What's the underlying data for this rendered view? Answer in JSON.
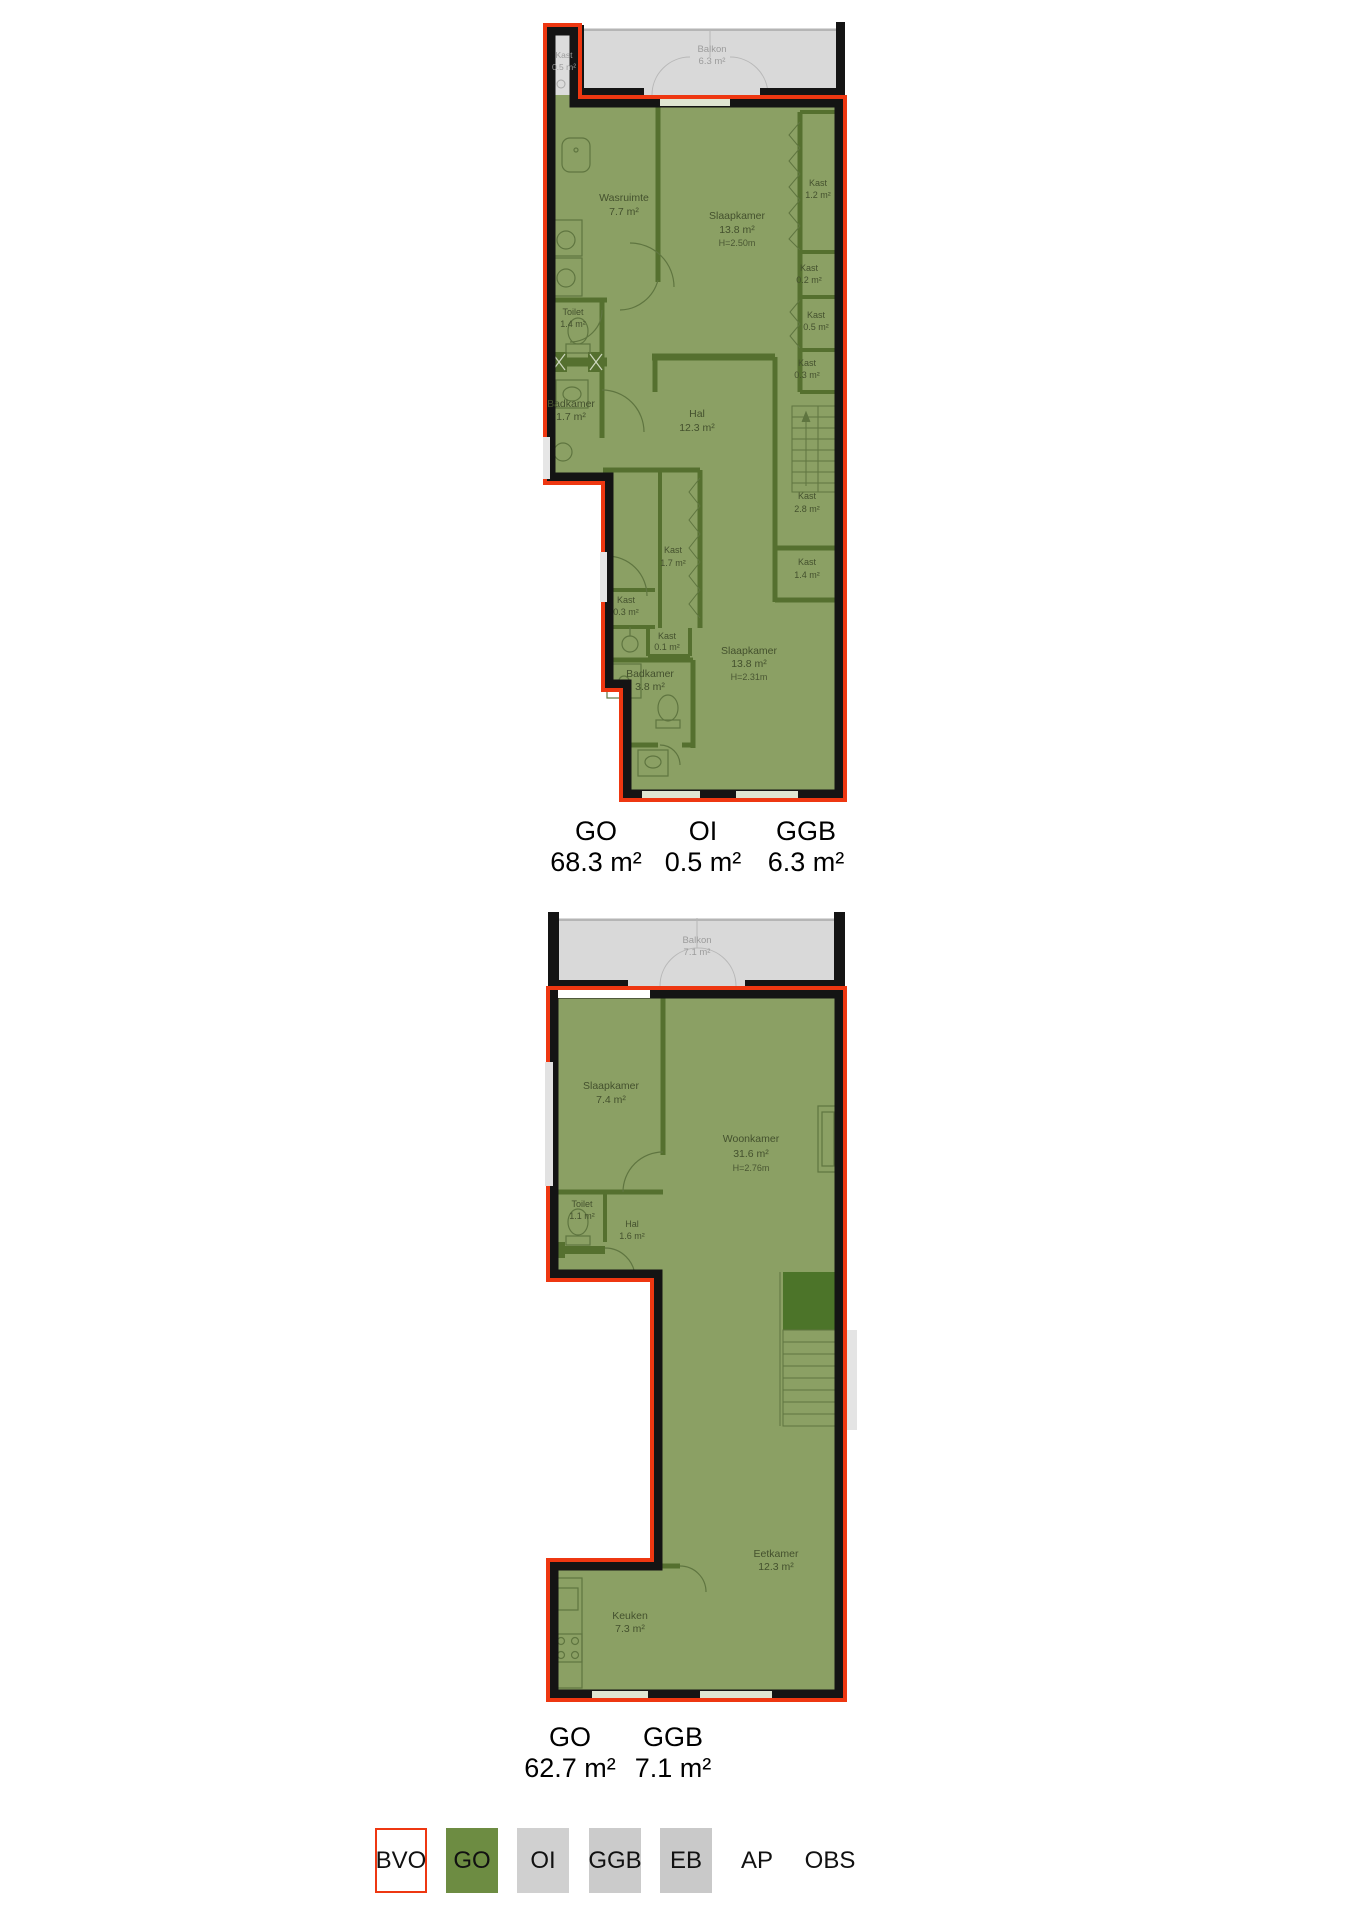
{
  "colors": {
    "bvo_outline_red": "#ee3711",
    "go_fill_green": "#8ba064",
    "go_legend_green": "#6d8c42",
    "interior_wall_green": "#55702f",
    "stairs_dark_green": "#4c7429",
    "wall_black": "#141414",
    "ggb_balkon_gray": "#d9d9d9",
    "oi_gray": "#d0d0d0",
    "eb_gray": "#c9c9c9"
  },
  "plan1": {
    "rooms": [
      {
        "name": "Kast",
        "area": "0.5 m²"
      },
      {
        "name": "Balkon",
        "area": "6.3 m²"
      },
      {
        "name": "Wasruimte",
        "area": "7.7 m²"
      },
      {
        "name": "Slaapkamer",
        "area": "13.8 m²",
        "height": "H=2.50m"
      },
      {
        "name": "Kast",
        "area": "1.2 m²"
      },
      {
        "name": "Kast",
        "area": "0.2 m²"
      },
      {
        "name": "Kast",
        "area": "0.5 m²"
      },
      {
        "name": "Kast",
        "area": "0.3 m²"
      },
      {
        "name": "Toilet",
        "area": "1.4 m²"
      },
      {
        "name": "Badkamer",
        "area": "1.7 m²"
      },
      {
        "name": "Hal",
        "area": "12.3 m²"
      },
      {
        "name": "Kast",
        "area": "2.8 m²"
      },
      {
        "name": "Kast",
        "area": "1.4 m²"
      },
      {
        "name": "Kast",
        "area": "1.7 m²"
      },
      {
        "name": "Kast",
        "area": "0.3 m²"
      },
      {
        "name": "Kast",
        "area": "0.1 m²"
      },
      {
        "name": "Badkamer",
        "area": "3.8 m²"
      },
      {
        "name": "Slaapkamer",
        "area": "13.8 m²",
        "height": "H=2.31m"
      }
    ],
    "stats": [
      {
        "label": "GO",
        "value": "68.3 m²"
      },
      {
        "label": "OI",
        "value": "0.5 m²"
      },
      {
        "label": "GGB",
        "value": "6.3 m²"
      }
    ]
  },
  "plan2": {
    "rooms": [
      {
        "name": "Balkon",
        "area": "7.1 m²"
      },
      {
        "name": "Slaapkamer",
        "area": "7.4 m²"
      },
      {
        "name": "Woonkamer",
        "area": "31.6 m²",
        "height": "H=2.76m"
      },
      {
        "name": "Toilet",
        "area": "1.1 m²"
      },
      {
        "name": "Hal",
        "area": "1.6 m²"
      },
      {
        "name": "Eetkamer",
        "area": "12.3 m²"
      },
      {
        "name": "Keuken",
        "area": "7.3 m²"
      }
    ],
    "stats": [
      {
        "label": "GO",
        "value": "62.7 m²"
      },
      {
        "label": "GGB",
        "value": "7.1 m²"
      }
    ]
  },
  "legend": {
    "items": [
      {
        "label": "BVO"
      },
      {
        "label": "GO"
      },
      {
        "label": "OI"
      },
      {
        "label": "GGB"
      },
      {
        "label": "EB"
      },
      {
        "label": "AP"
      },
      {
        "label": "OBS"
      }
    ]
  }
}
